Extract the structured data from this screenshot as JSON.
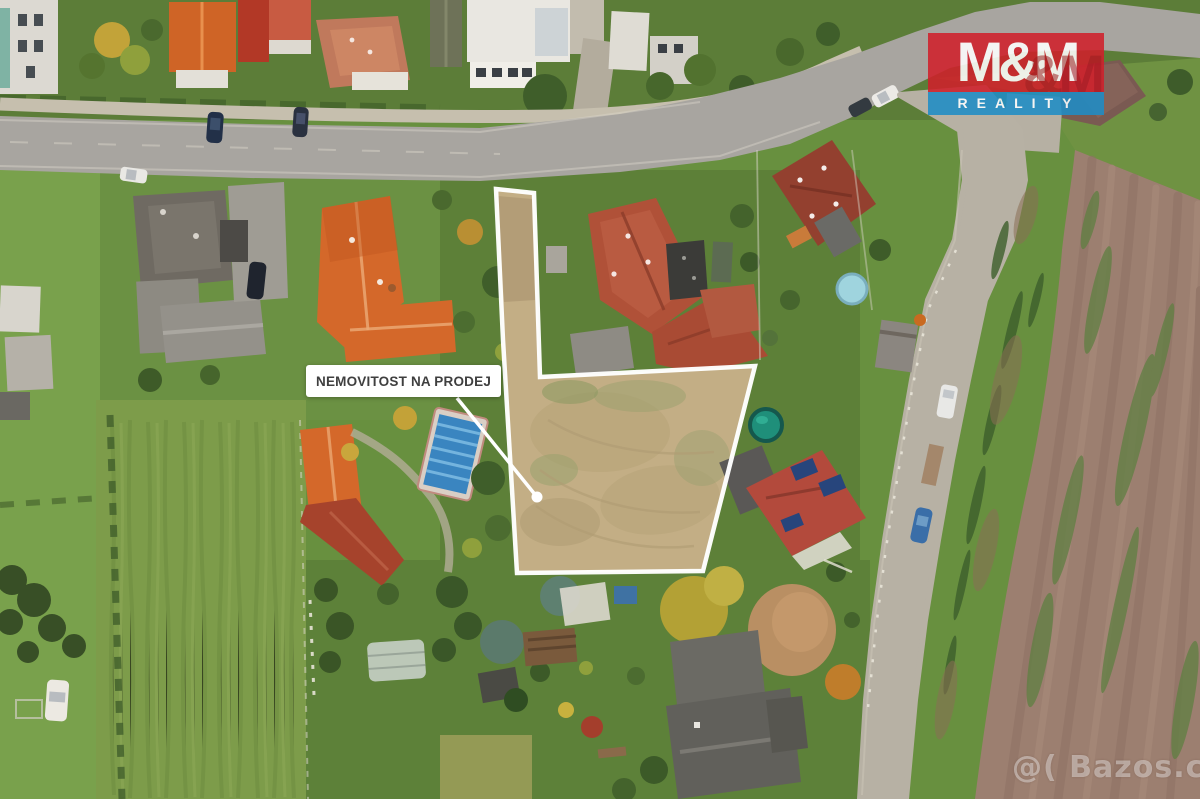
{
  "overlay": {
    "sale_label": {
      "text": "NEMOVITOST NA PRODEJ",
      "background": "#ffffff",
      "text_color": "#3f3f3f"
    },
    "logo": {
      "main": "M&M",
      "shadow": "&M",
      "subtitle": "REALITY",
      "red": "#d0202b",
      "blue": "#1f8dc6",
      "text_color": "#ffffff"
    },
    "watermark": {
      "text": "@( Bazos.cz",
      "color": "rgba(248,248,248,0.42)"
    }
  },
  "scene": {
    "type": "aerial-photo",
    "parcel_outline_color": "#ffffff",
    "parcel_fill": "#c3ae85",
    "pointer_dot_color": "#ffffff"
  }
}
